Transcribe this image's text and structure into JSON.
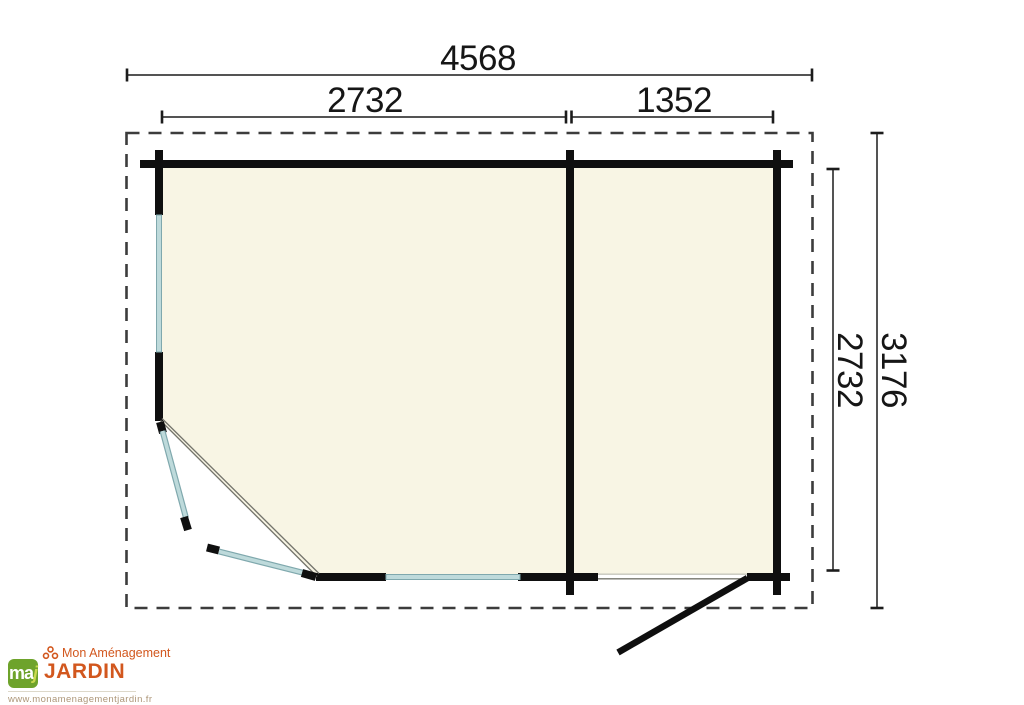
{
  "floor_plan": {
    "type": "garden-shed-floor-plan",
    "dims": {
      "overall_width_mm": "4568",
      "main_room_width_mm": "2732",
      "annex_width_mm": "1352",
      "inner_depth_mm": "2732",
      "overall_depth_mm": "3176"
    },
    "colors": {
      "wall": "#0f0f0f",
      "floor": "#f8f5e4",
      "window": "#bedadb",
      "window_edge": "#7fa8ad",
      "roof_dash": "#3c3c3c",
      "dimension_line": "#1c1c1c"
    },
    "features": [
      "corner-double-door-open",
      "annex-door-open",
      "left-wall-window",
      "front-wall-window",
      "partition-wall",
      "roof-overhang-outline"
    ]
  },
  "logo": {
    "badge_ma": "ma",
    "badge_j": "j",
    "line1": "Mon Aménagement",
    "line2": "JARDIN",
    "website": "www.monamenagementjardin.fr",
    "orange": "#d2571e",
    "green": "#6ea32b"
  }
}
